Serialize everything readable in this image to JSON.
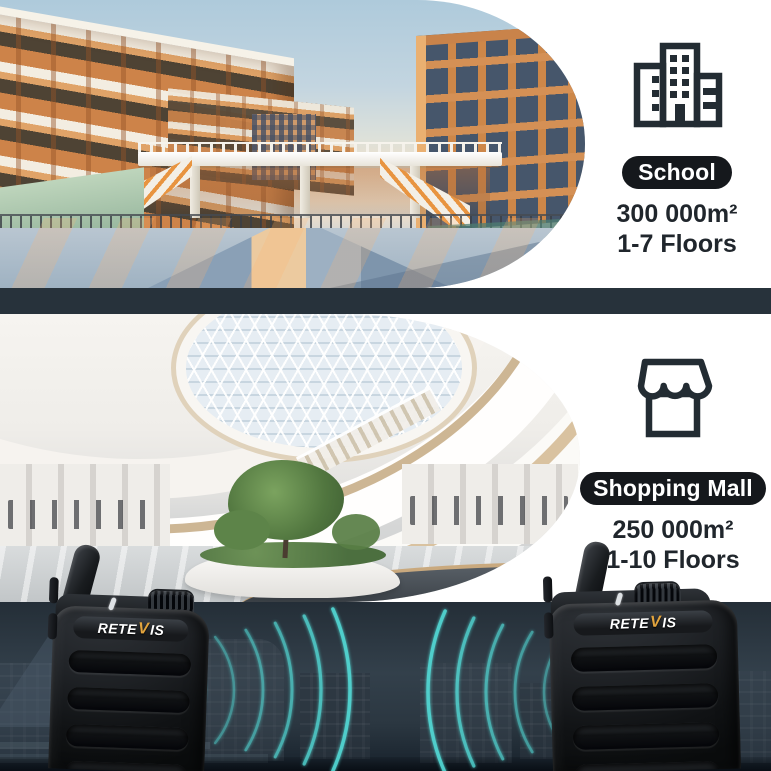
{
  "colors": {
    "accent_teal": "#52dbd7",
    "divider_band": "#27323b",
    "pill_background": "#15181c",
    "text_dark": "#20262c",
    "logo_gold": "#e2a43e"
  },
  "scenarios": {
    "school": {
      "icon": "building-icon",
      "label": "School",
      "area": "300 000m²",
      "floors": "1-7 Floors"
    },
    "mall": {
      "icon": "storefront-icon",
      "label": "Shopping Mall",
      "area": "250 000m²",
      "floors": "1-10 Floors"
    }
  },
  "devices": {
    "brand_pre": "RETE",
    "brand_v": "V",
    "brand_post": "IS"
  }
}
